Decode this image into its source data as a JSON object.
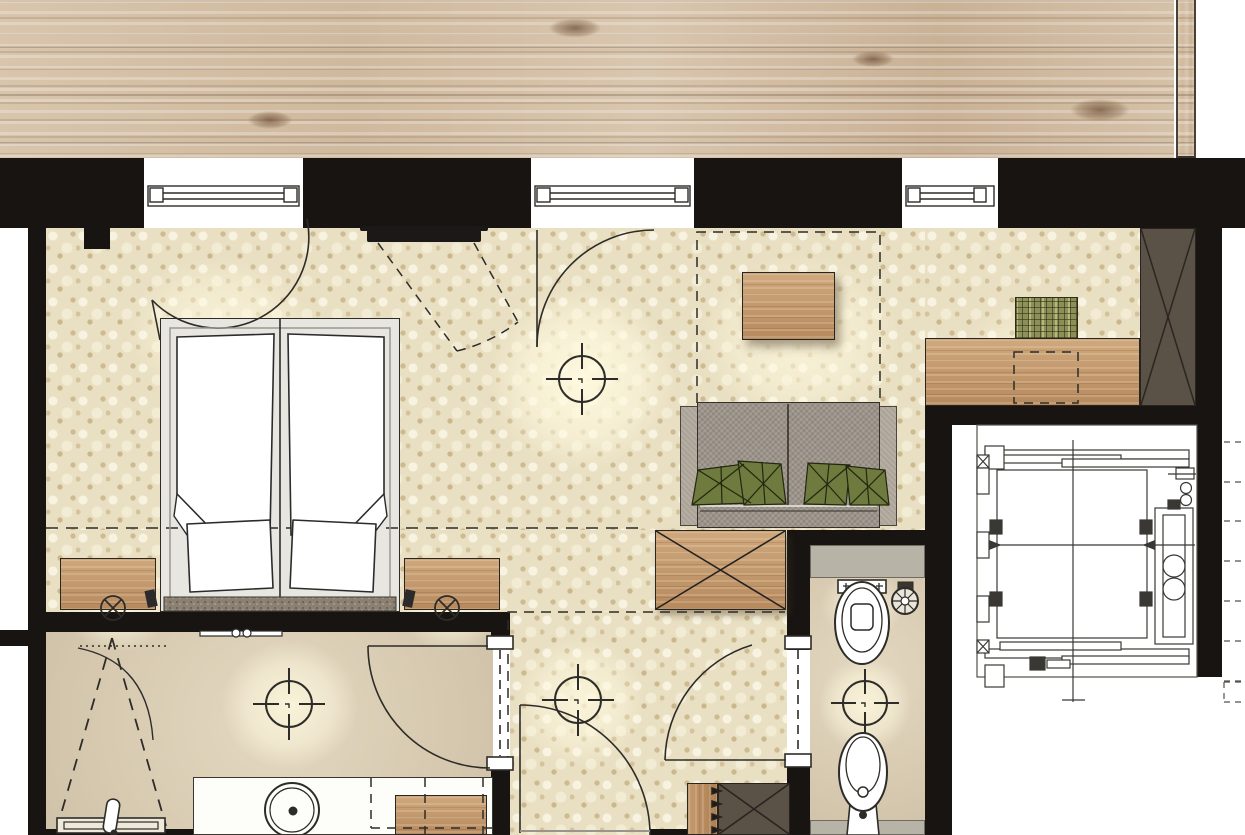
{
  "document": {
    "type": "architectural-floor-plan",
    "subject": "hotel guest room with bathroom, WC, entry and elevator shaft",
    "visible_text": [],
    "orientation": "top-down plan view"
  },
  "palette": {
    "wall_black": "#171412",
    "wood_deck": "#d2bda3",
    "carpet_cream": "#e9dfc2",
    "carpet_dot": "#b19660",
    "stone_floor": "#d8cbb2",
    "gray_counter": "#b7b3a6",
    "sofa_gray": "#9c948a",
    "cushion_olive": "#6e7a3e",
    "furniture_wood": "#c49c70",
    "closet_dark_brown": "#5a5147",
    "line_ink": "#2e2c28",
    "fixture_white": "#ffffff",
    "glow_warm": "#fffae0"
  },
  "rooms": [
    {
      "name": "wood-deck-top",
      "floor": "wood planks"
    },
    {
      "name": "bedroom-living",
      "floor": "cream knit carpet"
    },
    {
      "name": "bathroom",
      "floor": "stone"
    },
    {
      "name": "wc",
      "floor": "stone"
    },
    {
      "name": "entry-hall",
      "floor": "cream knit carpet"
    },
    {
      "name": "elevator-shaft",
      "floor": "technical drawing"
    },
    {
      "name": "landing",
      "floor": "white"
    }
  ],
  "openings": {
    "windows": 3,
    "door_swings": 6,
    "window_positions_px": [
      [
        144,
        303
      ],
      [
        531,
        694
      ],
      [
        902,
        998
      ]
    ]
  },
  "furniture": [
    {
      "name": "double-bed",
      "details": "two mattresses, two duvets with folded corners, two pillows, speckled headboard"
    },
    {
      "name": "nightstand-left"
    },
    {
      "name": "nightstand-right"
    },
    {
      "name": "pendant-lamp-left"
    },
    {
      "name": "pendant-lamp-right"
    },
    {
      "name": "wall-tv",
      "details": "mounted on pier between windows, dashed swivel cone"
    },
    {
      "name": "coffee-table-wood"
    },
    {
      "name": "sofa-two-seat",
      "details": "gray fabric, four olive faceted cushions"
    },
    {
      "name": "side-table-x-top"
    },
    {
      "name": "desk-wood"
    },
    {
      "name": "desk-chair-plaid"
    },
    {
      "name": "wardrobe-tall-dark"
    },
    {
      "name": "entry-closet-dark"
    },
    {
      "name": "entry-drawer-strip"
    },
    {
      "name": "vanity-counter"
    },
    {
      "name": "vanity-stool-wood"
    }
  ],
  "fixtures": [
    {
      "name": "round-basin"
    },
    {
      "name": "towel-bar"
    },
    {
      "name": "shower-head-and-tray",
      "details": "dashed spray triangle"
    },
    {
      "name": "toilet"
    },
    {
      "name": "bidet"
    },
    {
      "name": "toilet-paper-holder"
    },
    {
      "name": "ceiling-light-crosshair",
      "count": 4
    },
    {
      "name": "elevator-cab",
      "details": "guide rails, counterweight with two pulleys, telescopic doors"
    }
  ],
  "annotations": {
    "dashed_bed_centerline_y": 528,
    "dashed_layout_boxes": 3,
    "right_margin_tick_count": 7
  }
}
